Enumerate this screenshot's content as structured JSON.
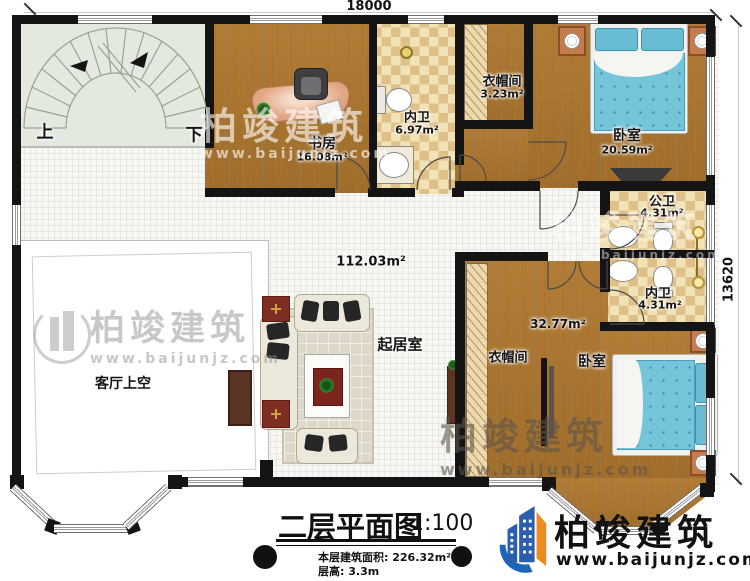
{
  "dimensions": {
    "top": "18000",
    "right": "13620"
  },
  "stairs": {
    "up": "上",
    "down": "下"
  },
  "rooms": {
    "study": {
      "label": "书房",
      "area": "16.08m²"
    },
    "bath_top": {
      "label": "内卫",
      "area": "6.97m²"
    },
    "closet_top": {
      "label": "衣帽间",
      "area": "3.23m²"
    },
    "bedroom_top": {
      "label": "卧室",
      "area": "20.59m²"
    },
    "bath_public": {
      "label": "公卫",
      "area": "4.31m²"
    },
    "bath_private": {
      "label": "内卫",
      "area": "4.31m²"
    },
    "living": {
      "label": "起居室",
      "area": "112.03m²"
    },
    "suite": {
      "area": "32.77m²",
      "closet_label": "衣帽间",
      "bedroom_label": "卧室"
    },
    "void_label": "客厅上空"
  },
  "title_block": {
    "title": "二层平面图",
    "scale": "1:100",
    "area_label": "本层建筑面积:",
    "area_value": "226.32m²",
    "height_label": "层高:",
    "height_value": "3.3m"
  },
  "brand": {
    "name": "柏竣建筑",
    "website": "www.baijunjz.com"
  },
  "watermark": {
    "name": "柏竣建筑",
    "website": "www.baijunjz.com"
  },
  "colors": {
    "wall": "#141414",
    "wood": "#aa7531",
    "tile_light": "#f1e3b8",
    "tile_dark": "#dfc088",
    "bed_blue": "#74c5d9",
    "logo_blue": "#2b5fad",
    "logo_orange": "#ef8b1d"
  }
}
